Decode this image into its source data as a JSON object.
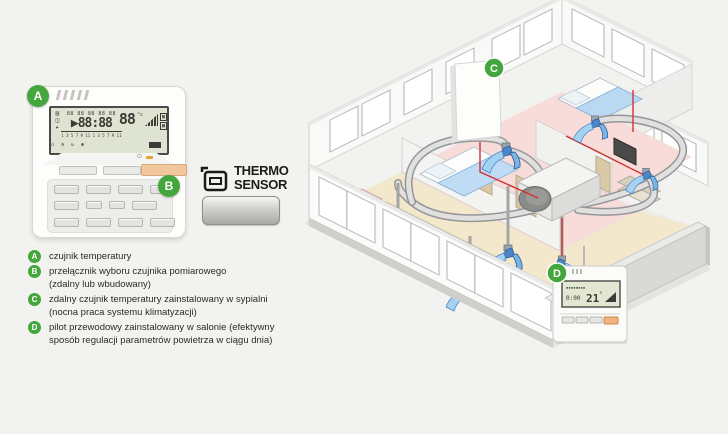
{
  "colors": {
    "background": "#f2f2f0",
    "badge_green": "#45a63d",
    "lcd_background": "#dfe3d2",
    "orange_button": "#f2c79e",
    "duct_gray": "#96969a",
    "wire_red": "#d03232",
    "floor_pink": "#f7dcda",
    "floor_beige": "#f4e8cc"
  },
  "badges": {
    "a": "A",
    "b": "B",
    "c": "C",
    "d": "D"
  },
  "thermo_sensor": {
    "line1": "THERMO",
    "line2": "SENSOR"
  },
  "controller_a": {
    "lcd": {
      "left_icons": [
        "▤",
        "◫",
        "▸"
      ],
      "schedule_row": "88 88 88 88 88",
      "arrow": "▶",
      "time": "88:88",
      "timeline": "1 3 5 7 9 11 1 3 5 7 9 11",
      "temp": "88",
      "temp_unit": "°c",
      "mode_a": "▦",
      "mode_b": "▩",
      "status_icons": "⌂ ◔ ↻ ✽"
    }
  },
  "wall_controller_d": {
    "display_small": "0:00",
    "display_temp": "21",
    "display_unit": "°"
  },
  "legend": {
    "items": [
      {
        "badge": "A",
        "lines": [
          "czujnik temperatury",
          ""
        ]
      },
      {
        "badge": "B",
        "lines": [
          "przełącznik wyboru czujnika pomiarowego",
          "(zdalny lub wbudowany)"
        ]
      },
      {
        "badge": "C",
        "lines": [
          "zdalny czujnik temperatury zainstalowany w sypialni",
          "(nocna praca systemu klimatyzacji)"
        ]
      },
      {
        "badge": "D",
        "lines": [
          "pilot przewodowy zainstalowany w salonie (efektywny",
          "sposób regulacji parametrów powietrza w ciągu dnia)"
        ]
      }
    ]
  }
}
